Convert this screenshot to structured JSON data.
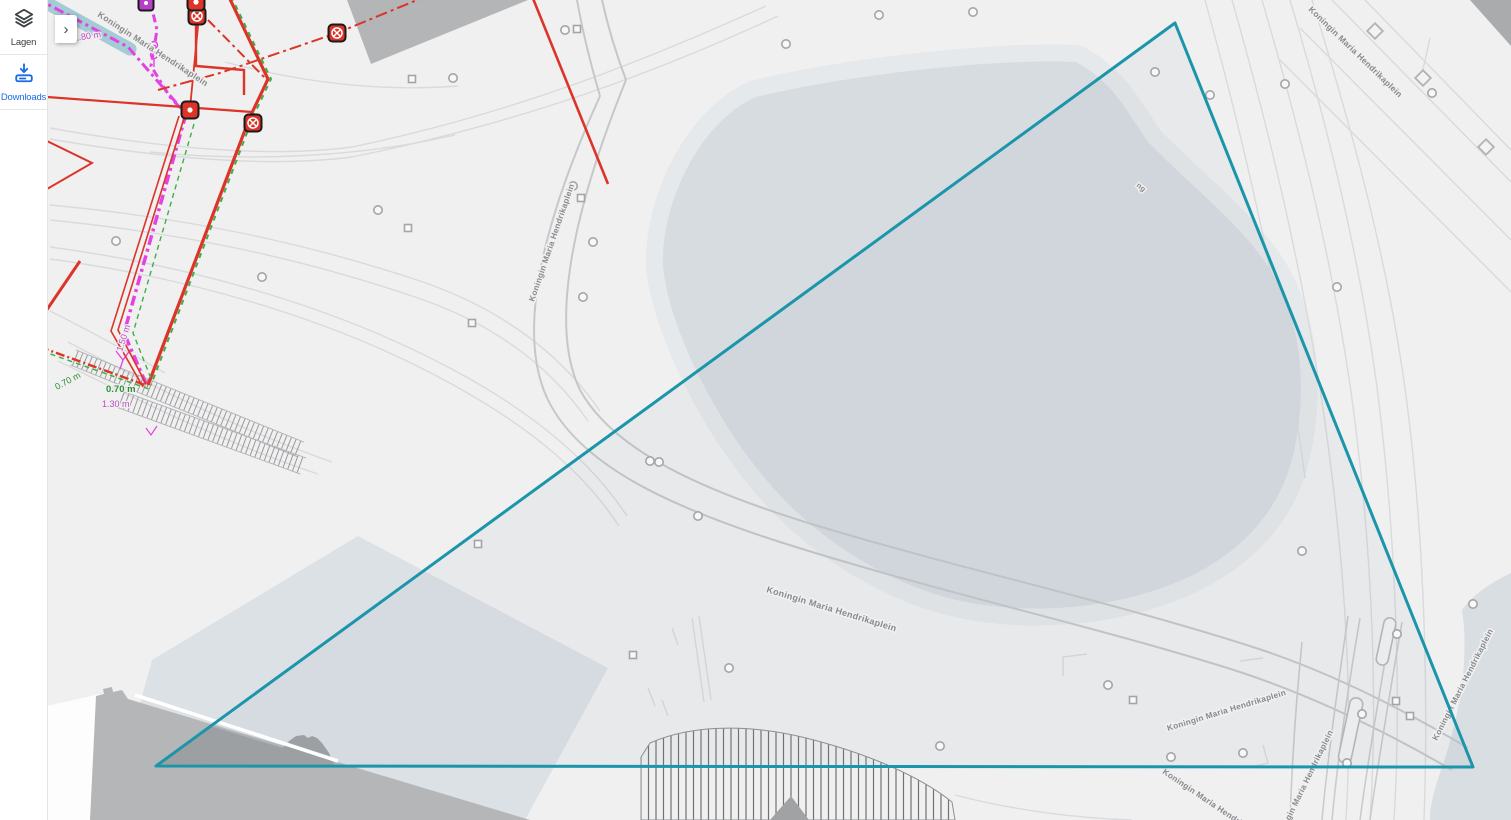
{
  "sidebar": {
    "items": [
      {
        "id": "lagen",
        "label": "Lagen",
        "icon": "layers-icon",
        "color": "#3c4043"
      },
      {
        "id": "downloads",
        "label": "Downloads",
        "icon": "download-icon",
        "color": "#1b6ce0"
      }
    ]
  },
  "panel_toggle": {
    "label": "›"
  },
  "map": {
    "colors": {
      "zone": "#1a95a9",
      "zone_fill": "rgba(127,148,158,0.07)",
      "red": "#dc3428",
      "magenta": "#e243e2",
      "magenta_label": "#c04ac0",
      "green": "#3fae49",
      "green_label": "#2f8f35",
      "purple_marker": "#b93fc9",
      "teal_band": "rgba(88,167,183,0.5)",
      "street_label": "#87898c"
    },
    "zone": {
      "type": "polygon",
      "points": [
        [
          1175,
          23
        ],
        [
          1473,
          767
        ],
        [
          156,
          766
        ]
      ]
    },
    "street_labels": [
      {
        "text": "Koningin Maria Hendrikaplein",
        "x": 97,
        "y": 16,
        "rot": 33,
        "size": 8.6
      },
      {
        "text": "Koningin Maria Hendrikaplein",
        "x": 534,
        "y": 302,
        "rot": -71,
        "size": 8.2
      },
      {
        "text": "Koningin Maria Hendrikaplein",
        "x": 766,
        "y": 592,
        "rot": 17,
        "size": 9
      },
      {
        "text": "Koningin Maria Hendrikaplein",
        "x": 1168,
        "y": 731,
        "rot": -17,
        "size": 8.2
      },
      {
        "text": "Koningin Maria Hendrikaplein",
        "x": 1162,
        "y": 773,
        "rot": 34,
        "size": 8.2
      },
      {
        "text": "Koningin Maria Hendrikaplein",
        "x": 1279,
        "y": 843,
        "rot": -64,
        "size": 8.2
      },
      {
        "text": "Koningin Maria Hendrikaplein",
        "x": 1437,
        "y": 741,
        "rot": -63,
        "size": 8.2
      },
      {
        "text": "Koningin Maria Hendrikaplein",
        "x": 1308,
        "y": 10,
        "rot": 44,
        "size": 8.4
      },
      {
        "text": "ng",
        "x": 1136,
        "y": 186,
        "rot": 40,
        "size": 7.5
      }
    ],
    "measurement_labels": [
      {
        "text": "1.80 m",
        "x": 74,
        "y": 41,
        "rot": -8,
        "color": "magenta",
        "bold": false
      },
      {
        "text": "1.50 m",
        "x": 122,
        "y": 352,
        "rot": -72,
        "color": "magenta",
        "bold": false
      },
      {
        "text": "0.70 m",
        "x": 57,
        "y": 390,
        "rot": -28,
        "color": "green",
        "bold": false
      },
      {
        "text": "0.70 m",
        "x": 106,
        "y": 392,
        "rot": 0,
        "color": "green",
        "bold": true
      },
      {
        "text": "1.30 m",
        "x": 102,
        "y": 407,
        "rot": 0,
        "color": "magenta",
        "bold": false
      }
    ],
    "markers": {
      "circles": [
        [
          378,
          210
        ],
        [
          262,
          277
        ],
        [
          116,
          241
        ],
        [
          453,
          78
        ],
        [
          565,
          30
        ],
        [
          573,
          186
        ],
        [
          593,
          242
        ],
        [
          583,
          297
        ],
        [
          650,
          461
        ],
        [
          659,
          462
        ],
        [
          698,
          516
        ],
        [
          786,
          44
        ],
        [
          879,
          15
        ],
        [
          973,
          12
        ],
        [
          1155,
          72
        ],
        [
          1210,
          95
        ],
        [
          1285,
          84
        ],
        [
          1432,
          93
        ],
        [
          1337,
          287
        ],
        [
          1302,
          551
        ],
        [
          1397,
          634
        ],
        [
          1362,
          714
        ],
        [
          1347,
          763
        ],
        [
          1171,
          757
        ],
        [
          1243,
          753
        ],
        [
          940,
          746
        ],
        [
          1108,
          685
        ],
        [
          729,
          668
        ],
        [
          1473,
          604
        ]
      ],
      "squares": [
        [
          412,
          79
        ],
        [
          408,
          228
        ],
        [
          472,
          323
        ],
        [
          478,
          544
        ],
        [
          581,
          198
        ],
        [
          577,
          29
        ],
        [
          633,
          655
        ],
        [
          1133,
          700
        ],
        [
          1396,
          701
        ],
        [
          1410,
          716
        ]
      ],
      "diamonds": [
        [
          1375,
          31
        ],
        [
          1423,
          78
        ],
        [
          1486,
          147
        ]
      ],
      "utility": [
        {
          "type": "circle-x",
          "x": 197,
          "y": 16
        },
        {
          "type": "circle-x",
          "x": 337,
          "y": 33
        },
        {
          "type": "circle-x",
          "x": 253,
          "y": 123
        },
        {
          "type": "dot",
          "x": 190,
          "y": 110
        },
        {
          "type": "dot",
          "x": 196,
          "y": 2
        },
        {
          "type": "purple-dot",
          "x": 146,
          "y": 3
        }
      ]
    }
  }
}
